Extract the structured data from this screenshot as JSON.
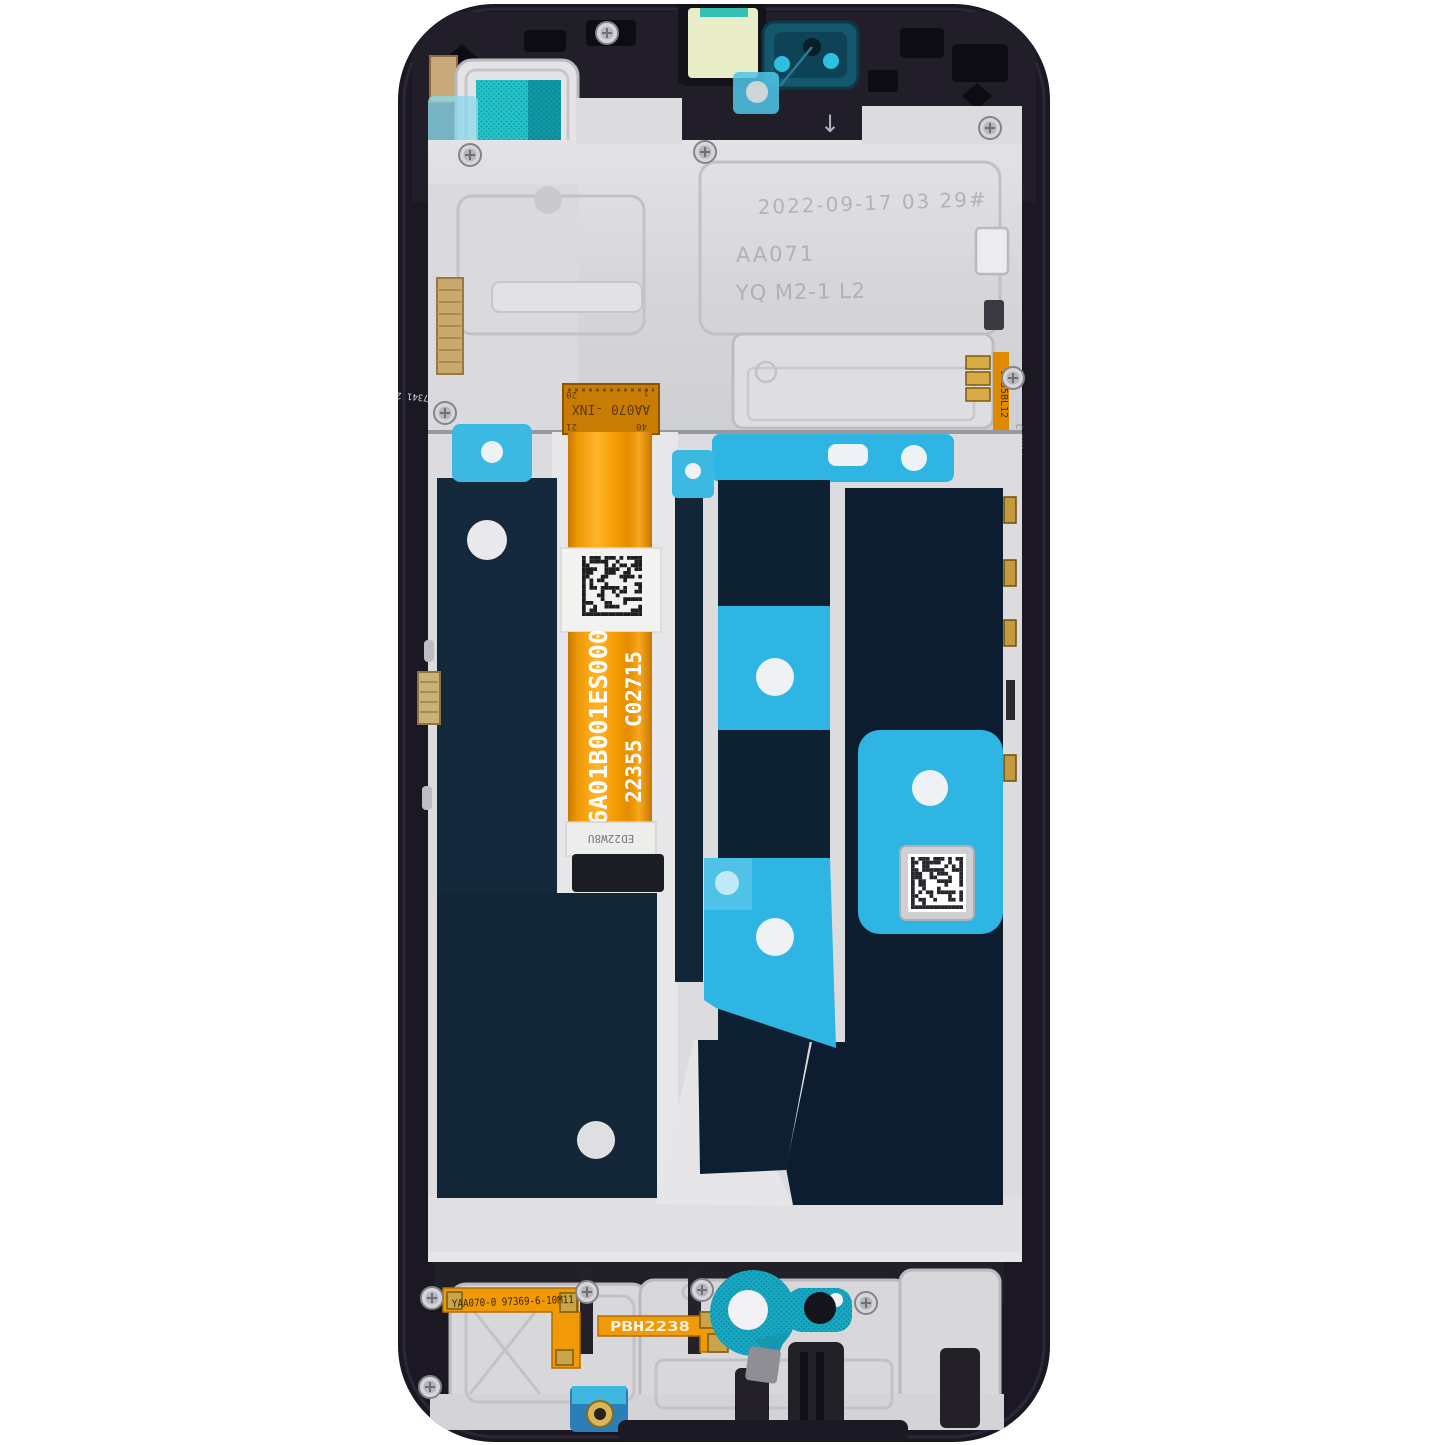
{
  "photo": {
    "subject": "Smartphone LCD display assembly with middle frame, internal rear view",
    "background": "#ffffff"
  },
  "colors": {
    "frame_dark": "#1b1823",
    "plate_silver": "#d8d8db",
    "panel_navy": "#102539",
    "adhesive_cyan": "#2fb5e4",
    "mesh_teal": "#21c1c7",
    "flex_orange": "#f59d05"
  },
  "markings": {
    "top_plate": {
      "date_code": "2022-09-17 03 29#",
      "code_line1": "AA071",
      "code_line2": "YQ M2-1 L2",
      "arrow_mark": "↓"
    },
    "main_flex": {
      "connector_label": "AA070 -INX",
      "pin_top_left": "20",
      "pin_top_right": "1",
      "pin_bottom_left": "21",
      "pin_bottom_right": "40",
      "part_number": "6A01B001ES000",
      "lot_code": "22355 C02715",
      "tab_code": "ED22W8U"
    },
    "bottom_left_flex_code": "YAA070-0 97369-6-10M11",
    "bottom_right_flex_code": "PBH2238",
    "left_edge_code": "XL-2237 97341 2",
    "right_edge_code": "9735BL12",
    "right_edge_code_2": "C 3M14"
  }
}
